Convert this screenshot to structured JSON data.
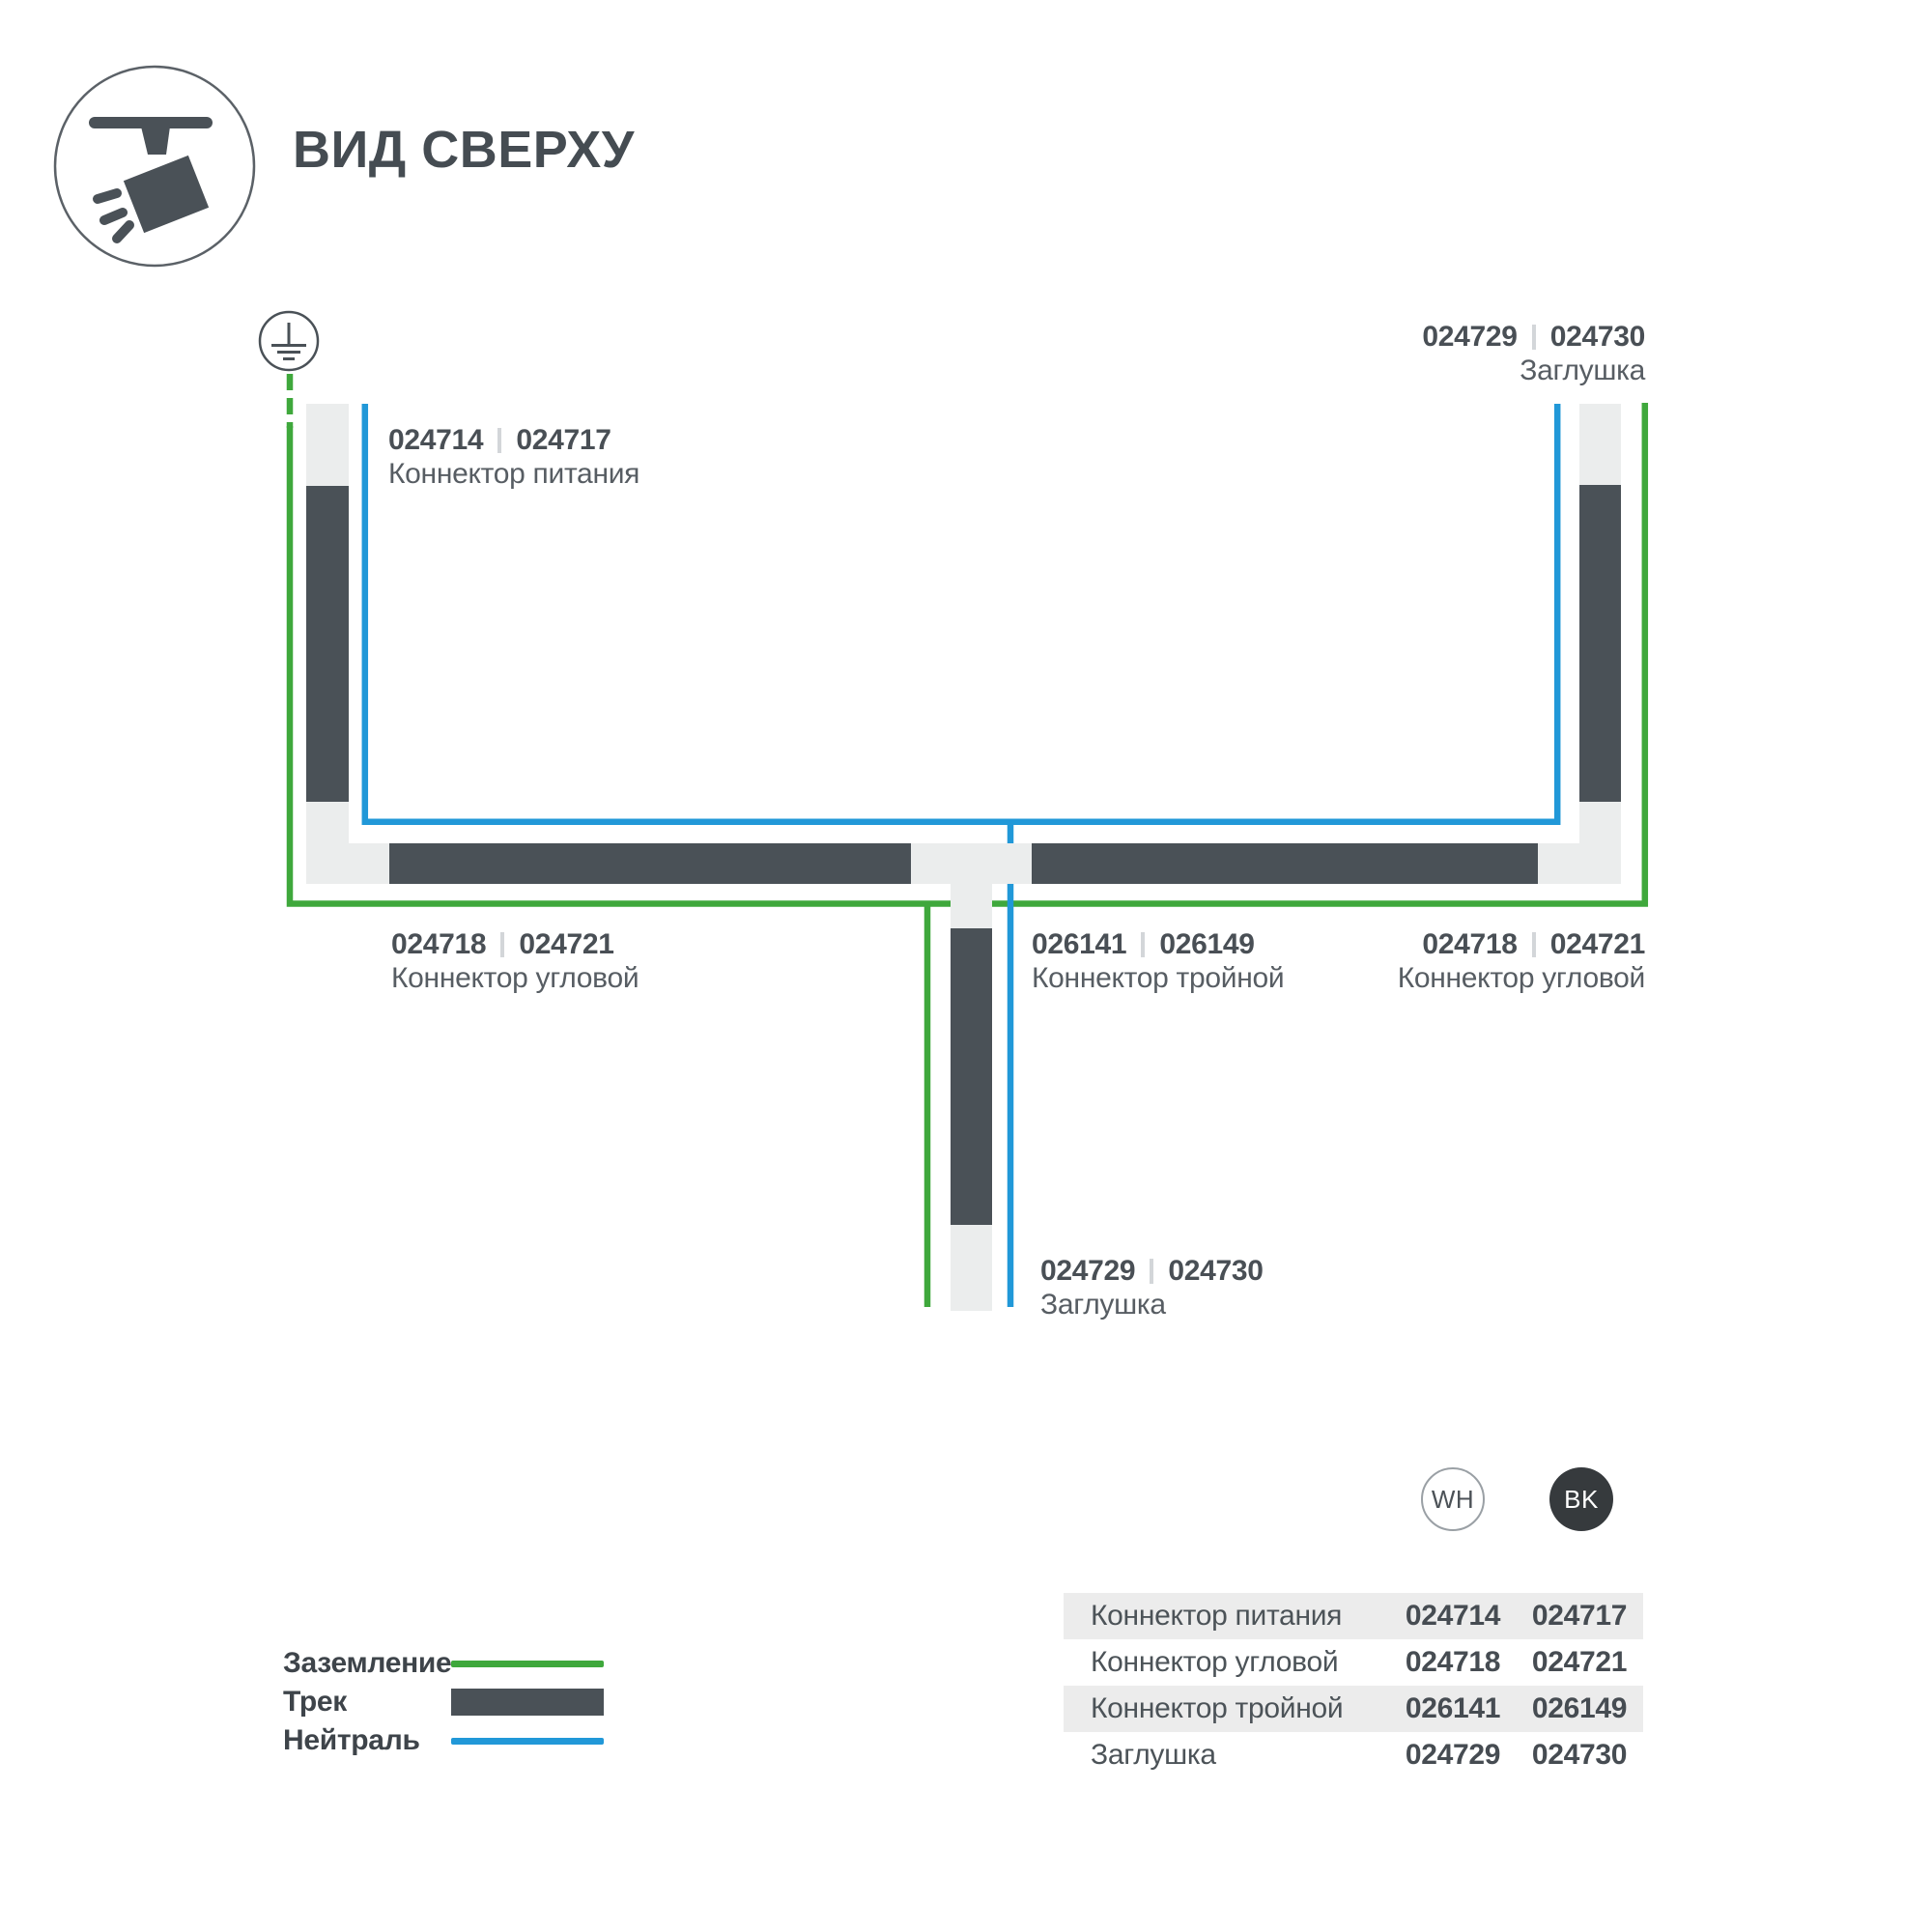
{
  "header": {
    "title": "ВИД СВЕРХУ"
  },
  "icon": {
    "name": "track-spotlight-top-view"
  },
  "colors": {
    "ground_green": "#3FA83C",
    "neutral_blue": "#2198D8",
    "track_dark": "#4A5157",
    "track_light": "#EBEDED",
    "table_row_gray": "#ECECEC"
  },
  "diagram": {
    "ground_symbol": "earth-ground",
    "labels": [
      {
        "wh": "024714",
        "bk": "024717",
        "name": "Коннектор питания"
      },
      {
        "wh": "024729",
        "bk": "024730",
        "name": "Заглушка"
      },
      {
        "wh": "024718",
        "bk": "024721",
        "name": "Коннектор угловой"
      },
      {
        "wh": "026141",
        "bk": "026149",
        "name": "Коннектор тройной"
      },
      {
        "wh": "024718",
        "bk": "024721",
        "name": "Коннектор угловой"
      },
      {
        "wh": "024729",
        "bk": "024730",
        "name": "Заглушка"
      }
    ]
  },
  "legend": {
    "items": [
      {
        "label": "Заземление",
        "type": "ground-line"
      },
      {
        "label": "Трек",
        "type": "track-bar"
      },
      {
        "label": "Нейтраль",
        "type": "neutral-line"
      }
    ]
  },
  "colorway": {
    "wh": "WH",
    "bk": "BK"
  },
  "table": {
    "rows": [
      {
        "name": "Коннектор питания",
        "wh": "024714",
        "bk": "024717"
      },
      {
        "name": "Коннектор угловой",
        "wh": "024718",
        "bk": "024721"
      },
      {
        "name": "Коннектор тройной",
        "wh": "026141",
        "bk": "026149"
      },
      {
        "name": "Заглушка",
        "wh": "024729",
        "bk": "024730"
      }
    ]
  }
}
